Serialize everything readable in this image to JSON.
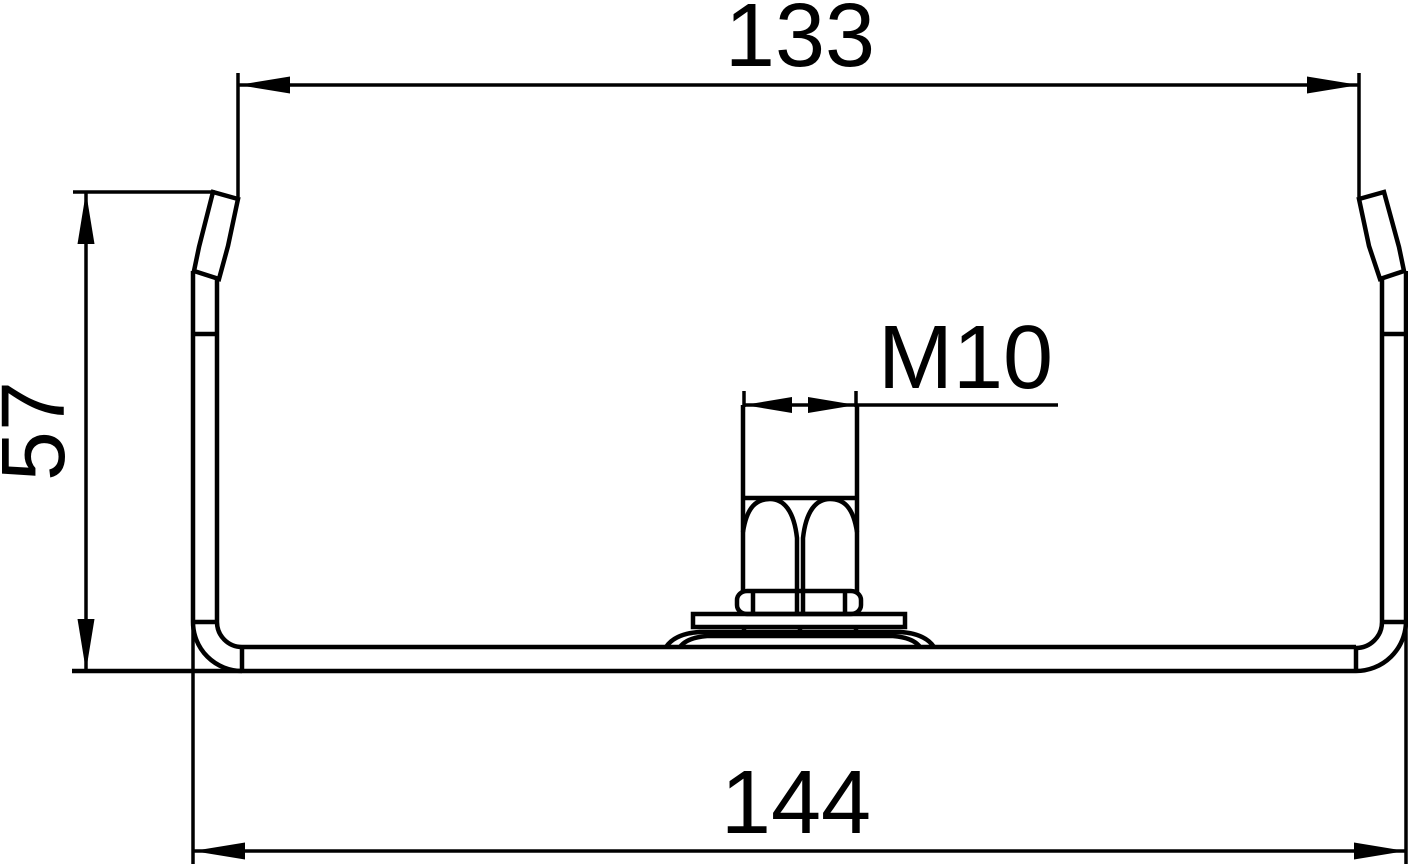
{
  "drawing": {
    "type_label": "channel-profile-cross-section",
    "dimensions": {
      "top_width": "133",
      "side_height": "57",
      "bottom_width": "144",
      "thread": "M10"
    },
    "colors": {
      "line": "#000000",
      "background": "#ffffff"
    }
  }
}
